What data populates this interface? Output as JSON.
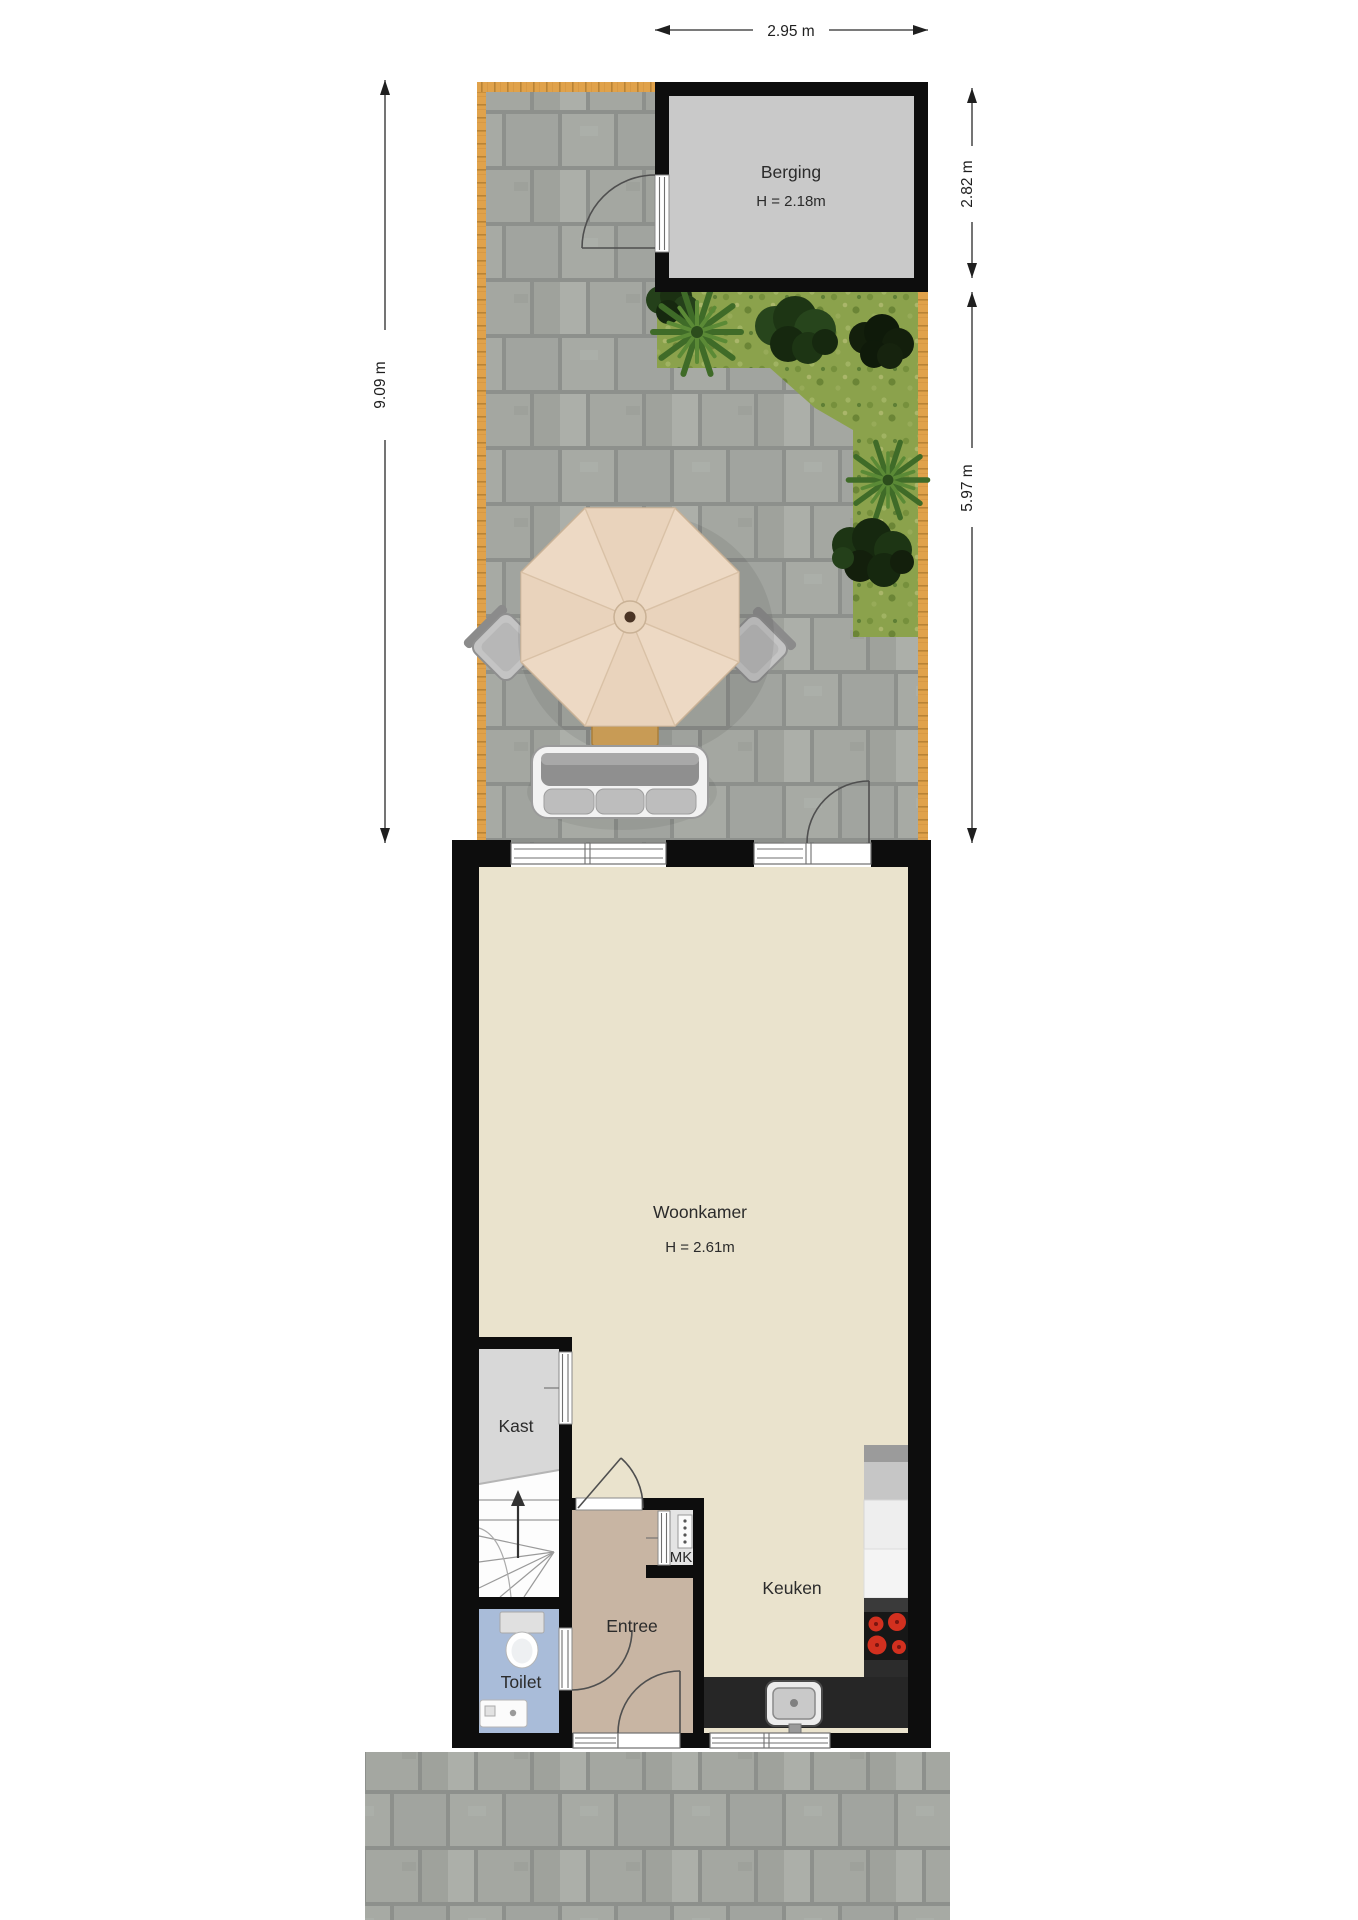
{
  "rooms": {
    "berging": {
      "label": "Berging",
      "ceiling": "H = 2.18m"
    },
    "woonkamer": {
      "label": "Woonkamer",
      "ceiling": "H = 2.61m"
    },
    "kast": {
      "label": "Kast"
    },
    "toilet": {
      "label": "Toilet"
    },
    "entree": {
      "label": "Entree"
    },
    "meterkast": {
      "label": "MK"
    },
    "keuken": {
      "label": "Keuken"
    }
  },
  "dimensions": {
    "top_width": "2.95 m",
    "left_total_depth": "9.09 m",
    "right_berging_depth": "2.82 m",
    "right_garden_depth": "5.97 m"
  },
  "colors": {
    "wall": "#0d0d0d",
    "floor_living": "#eae3cd",
    "floor_entree": "#c8b5a3",
    "floor_toilet": "#a9bcd9",
    "floor_kast": "#d8d8d8",
    "floor_berging": "#c9c9c9",
    "floor_mk": "#e4e4e4",
    "fence_wood": "#e0a24b",
    "paving_tile": "#a7aaa4",
    "grass": "#8ba24c",
    "counter_dark": "#262626",
    "burner_red": "#d2301f"
  },
  "icons": [
    "fence",
    "paving-tiles",
    "grass",
    "palm-plant",
    "tree-bush",
    "parasol",
    "garden-table",
    "garden-chair",
    "garden-bench",
    "door-swing-arc",
    "window-frame",
    "staircase",
    "up-arrow",
    "toilet-fixture",
    "hand-basin",
    "meter-box",
    "fridge",
    "cooktop-burners",
    "kitchen-sink",
    "kitchen-counter"
  ]
}
